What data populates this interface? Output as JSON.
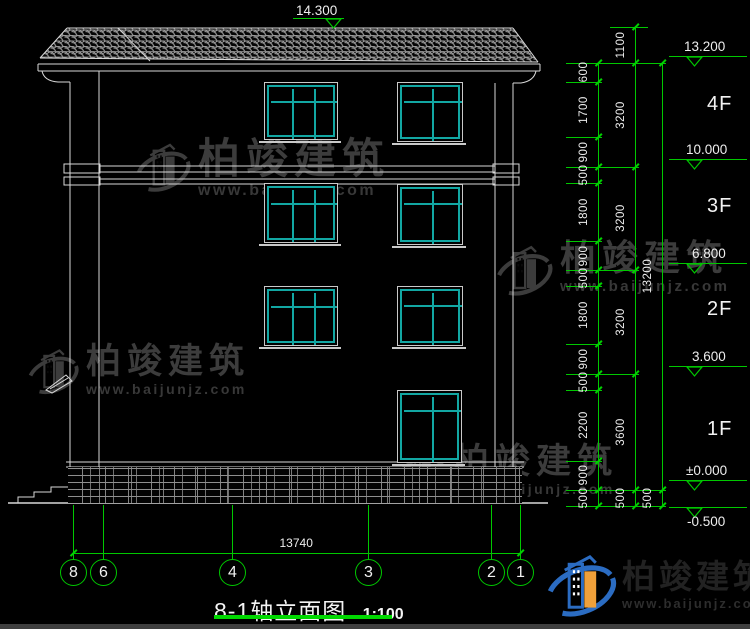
{
  "colors": {
    "green": "#00c800",
    "cyan": "#12a7a3",
    "line": "#d8d8d8",
    "text": "#ededed",
    "watermark": "#3c3c3c",
    "logo_blue": "#2b6cc2",
    "logo_orange": "#efa03a",
    "underline_green": "#00d800"
  },
  "title": {
    "text": "8-1轴立面图",
    "scale": "1:100"
  },
  "watermark": {
    "brand": "柏竣建筑",
    "url": "www.baijunjz.com",
    "instances": [
      {
        "x": 134,
        "y": 138,
        "icon": 58,
        "fs": 42,
        "ufs": 16
      },
      {
        "x": 26,
        "y": 344,
        "icon": 54,
        "fs": 35,
        "ufs": 14
      },
      {
        "x": 390,
        "y": 444,
        "icon": 58,
        "fs": 35,
        "ufs": 14
      },
      {
        "x": 494,
        "y": 240,
        "icon": 60,
        "fs": 36,
        "ufs": 15
      }
    ]
  },
  "logo": {
    "brand": "柏竣建筑",
    "url": "www.baijunjz.com"
  },
  "drawing": {
    "elevation_marks": [
      {
        "text": "14.300",
        "tx": 296,
        "ty": 3,
        "x1": 293,
        "x2": 344,
        "ly": 18,
        "trix": 325
      },
      {
        "text": "13.200",
        "tx": 684,
        "ty": 39,
        "x1": 669,
        "x2": 747,
        "ly": 56,
        "trix": 686
      },
      {
        "text": "10.000",
        "tx": 686,
        "ty": 142,
        "x1": 669,
        "x2": 747,
        "ly": 159,
        "trix": 686
      },
      {
        "text": "6.800",
        "tx": 692,
        "ty": 246,
        "x1": 669,
        "x2": 747,
        "ly": 263,
        "trix": 686
      },
      {
        "text": "3.600",
        "tx": 692,
        "ty": 349,
        "x1": 669,
        "x2": 747,
        "ly": 366,
        "trix": 686
      },
      {
        "text": "±0.000",
        "tx": 686,
        "ty": 463,
        "x1": 669,
        "x2": 747,
        "ly": 480,
        "trix": 686
      },
      {
        "text": "-0.500",
        "tx": 687,
        "ty": 514,
        "x1": 669,
        "x2": 747,
        "ly": 507,
        "trix": 686
      }
    ],
    "floor_labels": [
      {
        "text": "4F",
        "x": 707,
        "y": 93
      },
      {
        "text": "3F",
        "x": 707,
        "y": 195
      },
      {
        "text": "2F",
        "x": 707,
        "y": 298
      },
      {
        "text": "1F",
        "x": 707,
        "y": 418
      }
    ],
    "dim_cols": [
      {
        "x": 598,
        "y1": 63,
        "y2": 506,
        "ticks": [
          63,
          82,
          137,
          167,
          183,
          241,
          270,
          286,
          344,
          374,
          390,
          461,
          490,
          506
        ],
        "labels": [
          {
            "t": "600",
            "y": 72
          },
          {
            "t": "1700",
            "y": 110
          },
          {
            "t": "900",
            "y": 152
          },
          {
            "t": "500",
            "y": 175
          },
          {
            "t": "1800",
            "y": 212
          },
          {
            "t": "900",
            "y": 256
          },
          {
            "t": "500",
            "y": 278
          },
          {
            "t": "1800",
            "y": 315
          },
          {
            "t": "900",
            "y": 359
          },
          {
            "t": "500",
            "y": 382
          },
          {
            "t": "2200",
            "y": 425
          },
          {
            "t": "900",
            "y": 475
          },
          {
            "t": "500",
            "y": 498
          }
        ]
      },
      {
        "x": 635,
        "y1": 27,
        "y2": 506,
        "ticks": [
          27,
          63,
          167,
          270,
          374,
          490,
          506
        ],
        "labels": [
          {
            "t": "1100",
            "y": 45
          },
          {
            "t": "3200",
            "y": 115
          },
          {
            "t": "3200",
            "y": 218
          },
          {
            "t": "3200",
            "y": 322
          },
          {
            "t": "3600",
            "y": 432
          },
          {
            "t": "500",
            "y": 498
          }
        ]
      },
      {
        "x": 662,
        "y1": 63,
        "y2": 506,
        "ticks": [
          63,
          490,
          506
        ],
        "labels": [
          {
            "t": "13200",
            "y": 276
          },
          {
            "t": "500",
            "y": 498
          }
        ]
      }
    ],
    "ext_lines": [
      {
        "y": 27,
        "x1": 610,
        "x2": 648
      },
      {
        "y": 63,
        "x1": 566,
        "x2": 666
      },
      {
        "y": 82,
        "x1": 566,
        "x2": 602
      },
      {
        "y": 137,
        "x1": 566,
        "x2": 602
      },
      {
        "y": 167,
        "x1": 566,
        "x2": 639
      },
      {
        "y": 183,
        "x1": 566,
        "x2": 602
      },
      {
        "y": 241,
        "x1": 566,
        "x2": 602
      },
      {
        "y": 270,
        "x1": 566,
        "x2": 639
      },
      {
        "y": 286,
        "x1": 566,
        "x2": 602
      },
      {
        "y": 344,
        "x1": 566,
        "x2": 602
      },
      {
        "y": 374,
        "x1": 566,
        "x2": 639
      },
      {
        "y": 390,
        "x1": 566,
        "x2": 602
      },
      {
        "y": 461,
        "x1": 566,
        "x2": 602
      },
      {
        "y": 490,
        "x1": 566,
        "x2": 666
      },
      {
        "y": 506,
        "x1": 566,
        "x2": 666
      }
    ],
    "windows": [
      {
        "x": 264,
        "y": 82,
        "w": 72,
        "h": 56,
        "cols": 3,
        "transom": 0.3
      },
      {
        "x": 397,
        "y": 82,
        "w": 64,
        "h": 58,
        "cols": 2,
        "transom": 0.28
      },
      {
        "x": 264,
        "y": 183,
        "w": 72,
        "h": 58,
        "cols": 3,
        "transom": 0.3
      },
      {
        "x": 397,
        "y": 184,
        "w": 64,
        "h": 59,
        "cols": 2,
        "transom": 0.28
      },
      {
        "x": 264,
        "y": 286,
        "w": 72,
        "h": 58,
        "cols": 3,
        "transom": 0.3
      },
      {
        "x": 397,
        "y": 286,
        "w": 64,
        "h": 58,
        "cols": 2,
        "transom": 0.28
      },
      {
        "x": 397,
        "y": 390,
        "w": 63,
        "h": 71,
        "cols": 2,
        "transom": 0.24
      }
    ],
    "axis": {
      "dim_text": "13740",
      "dim_y": 553,
      "x1": 73,
      "x2": 520,
      "bubble_y": 572,
      "bubbles": [
        {
          "t": "8",
          "x": 73
        },
        {
          "t": "6",
          "x": 103
        },
        {
          "t": "4",
          "x": 232
        },
        {
          "t": "3",
          "x": 368
        },
        {
          "t": "2",
          "x": 491
        },
        {
          "t": "1",
          "x": 520
        }
      ]
    }
  }
}
